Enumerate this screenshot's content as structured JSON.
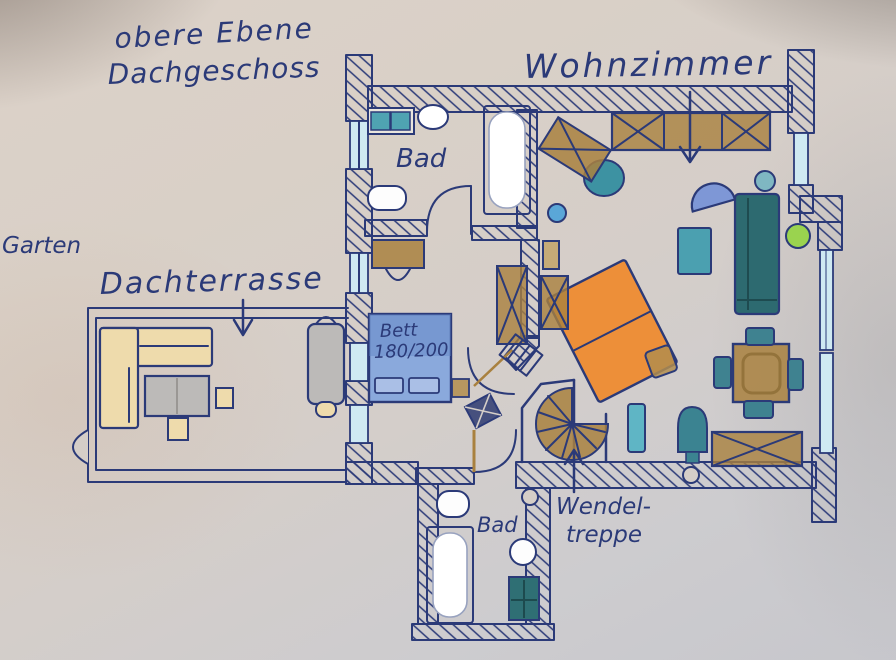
{
  "plan": {
    "title_line1": "obere Ebene",
    "title_line2": "Dachgeschoss",
    "living_room_label": "Wohnzimmer",
    "bath_upper_label": "Bad",
    "bath_lower_label": "Bad",
    "garden_label": "Garten",
    "terrace_label": "Dachterrasse",
    "bed_label_line1": "Bett",
    "bed_label_line2": "180/200",
    "stairs_label_line1": "Wendel-",
    "stairs_label_line2": "treppe"
  },
  "palette": {
    "ink_blue": "#2b3a78",
    "paper_beige": "#d5cec8",
    "furniture_wood": "#a9813f",
    "sofa_beige": "#eedbac",
    "table_gray": "#bcbab8",
    "sofa_teal_dark": "#2d6a70",
    "chair_teal": "#3f8290",
    "window_glass": "#cfe9f2",
    "bed_blue": "#8aa9dc",
    "armchair_blue": "#7e97d6",
    "plant_green": "#9ad34f",
    "daybed_orange": "#ef8a2c",
    "stool_blue": "#5aa7d8"
  }
}
